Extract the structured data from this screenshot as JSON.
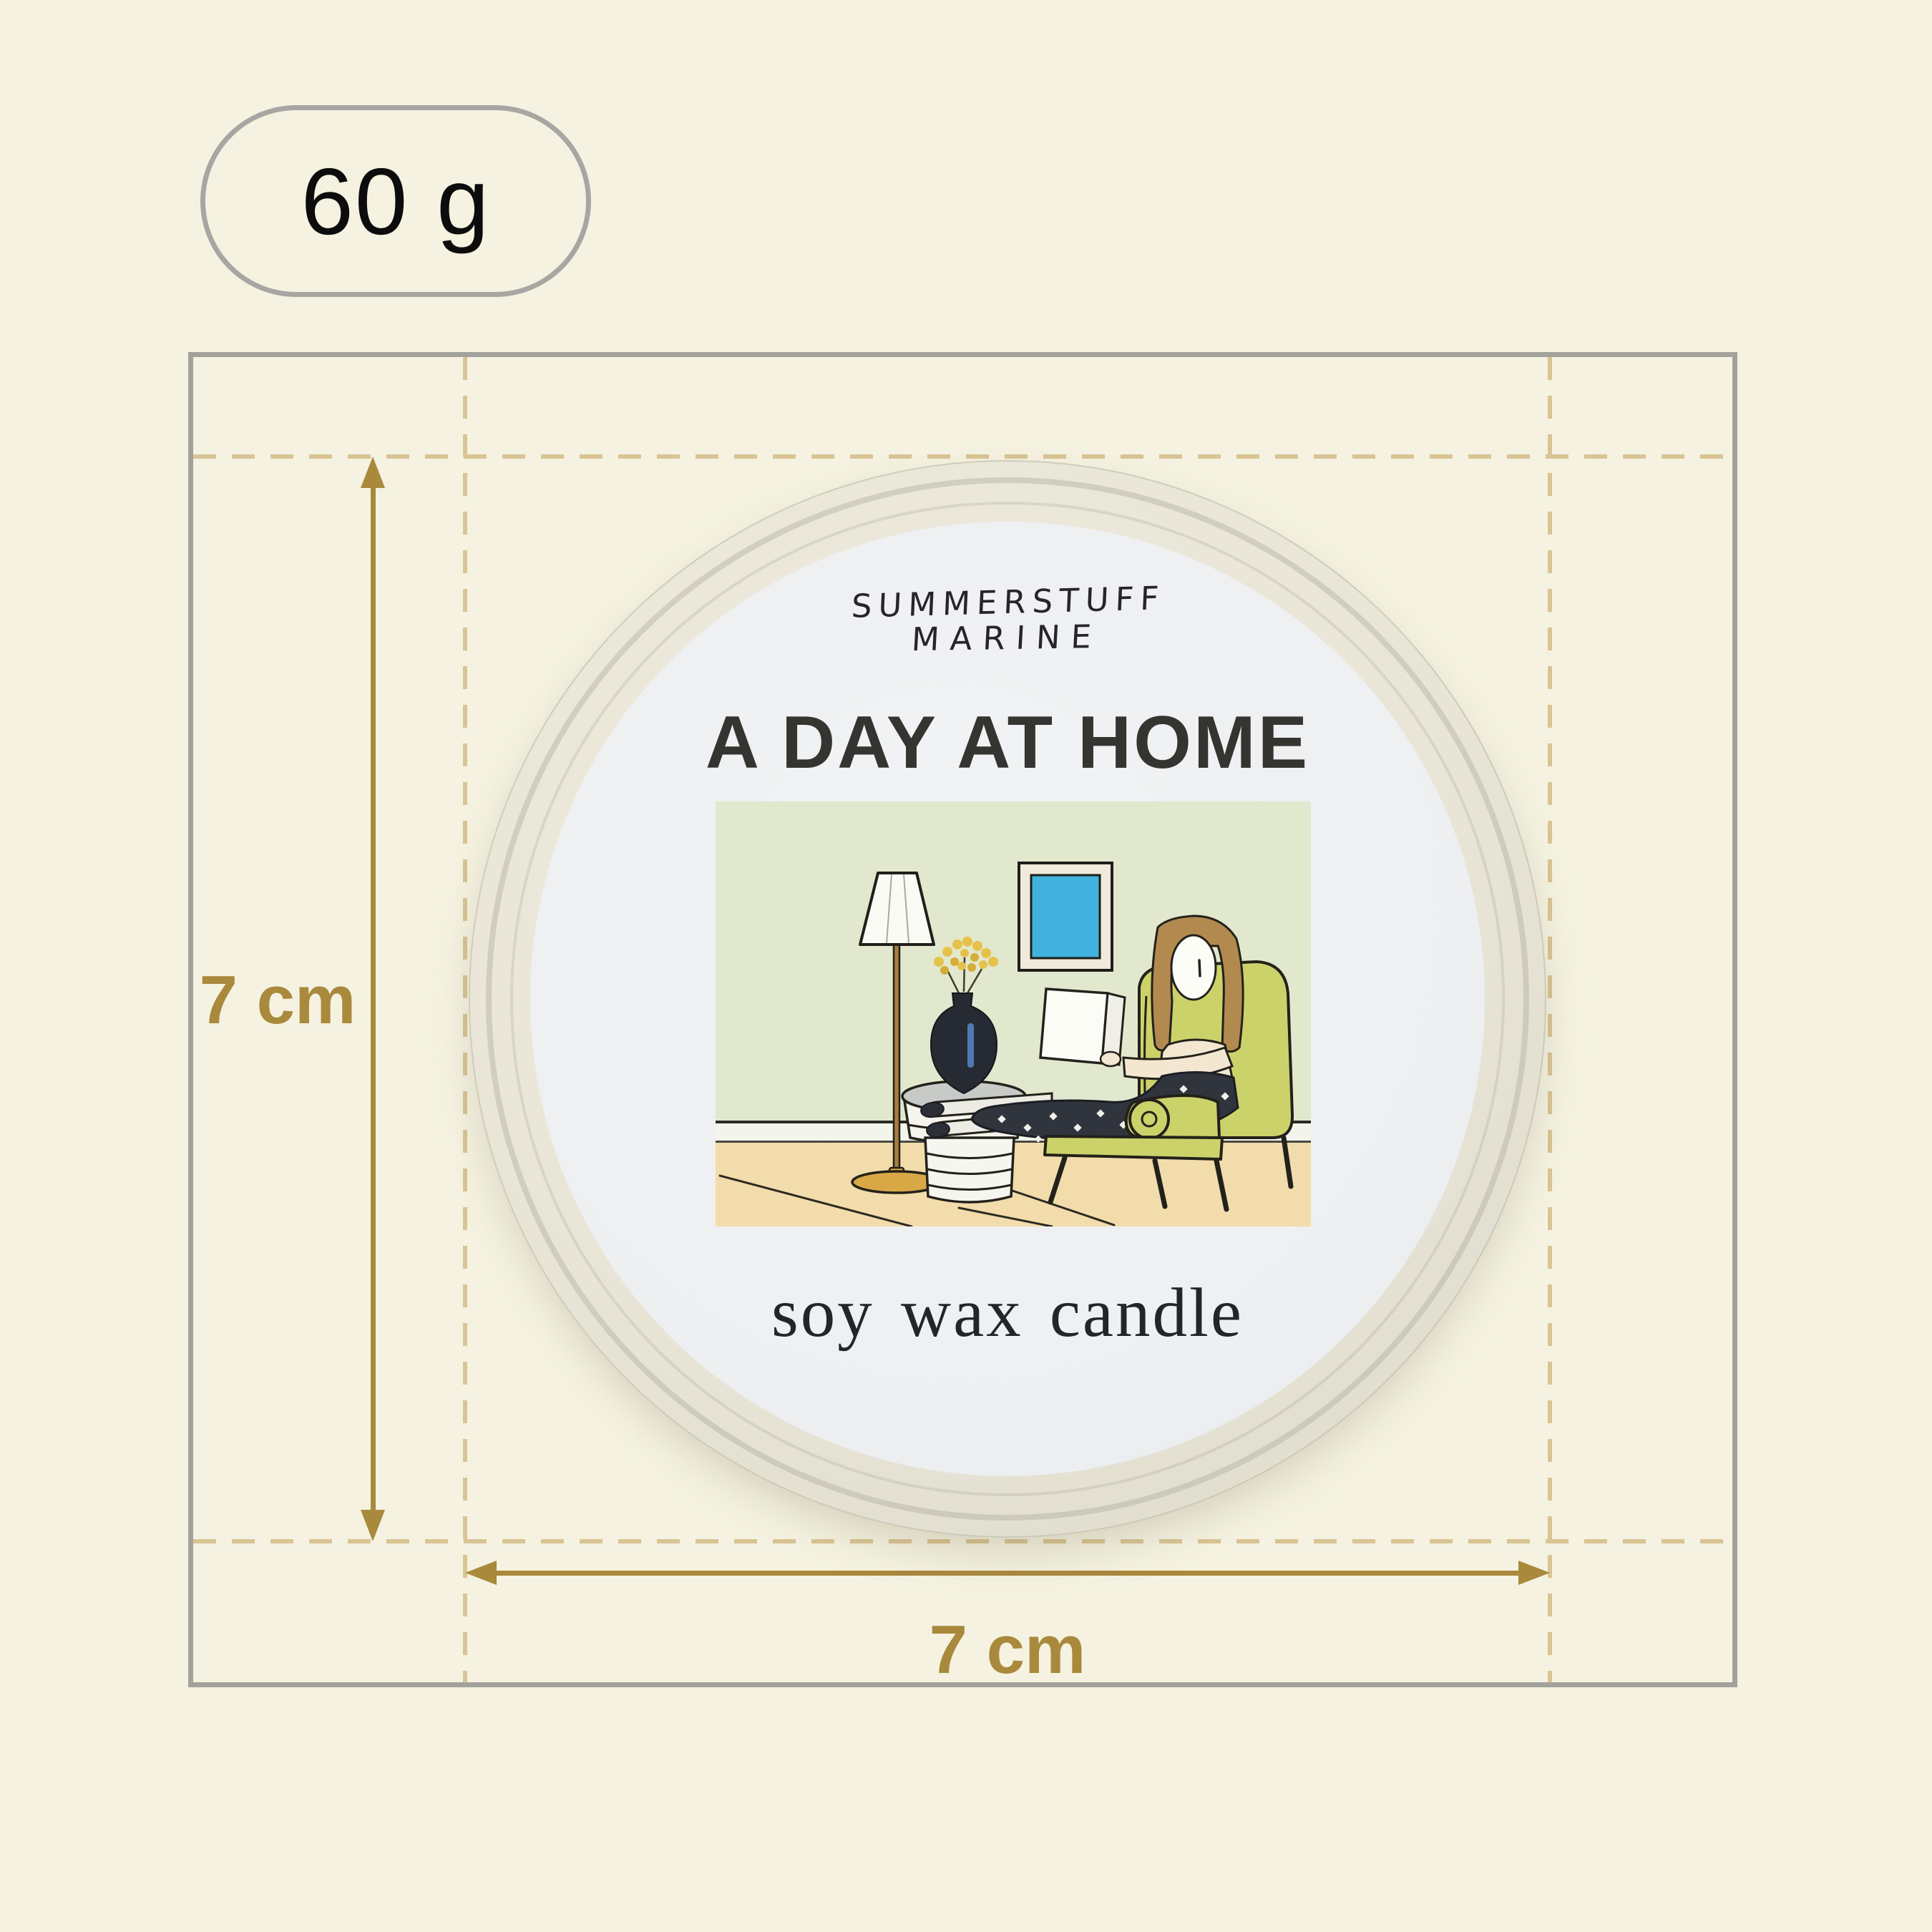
{
  "page": {
    "background": "#f5f2e1"
  },
  "weight_badge": {
    "label": "60 g"
  },
  "dimensions": {
    "height_label": "7 cm",
    "width_label": "7 cm"
  },
  "tin": {
    "brand_line1": "SUMMERSTUFF",
    "brand_line2": "MARINE",
    "title": "A DAY AT HOME",
    "subtitle": "soy wax candle"
  },
  "palette": {
    "background": "#f5f2e1",
    "badge_border": "#a8a6a2",
    "box_border": "#a3a19c",
    "dash": "#d9c493",
    "gold": "#a9893c",
    "tin_body": "#e9e6d8",
    "tin_label": "#eef0f2",
    "illustration": {
      "wall": "#e2e8ce",
      "floor": "#f2dcab",
      "baseboard": "#f3f4ec",
      "chair": "#ccd26a",
      "hair": "#b28a4f",
      "skin": "#f3e7d1",
      "skirt": "#30343d",
      "frame_blue": "#41b1de",
      "lamp_base": "#d9a846",
      "table_top": "#c7cac7",
      "vase": "#262b33",
      "flower": "#e6c24b",
      "outline": "#23211a"
    }
  }
}
